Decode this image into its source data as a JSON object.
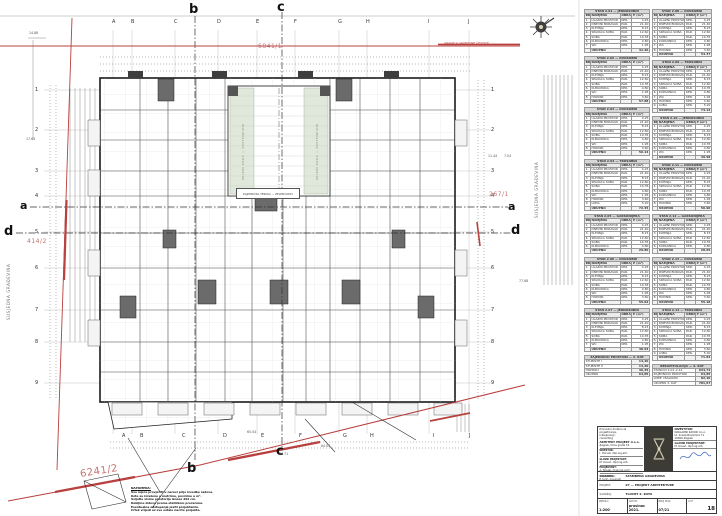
{
  "colors": {
    "boundary_red": "#b8403e",
    "parcel_red": "#c4706e",
    "green_roof": "#e0e8dc",
    "wall": "#1a1a1a"
  },
  "sheet": {
    "parcel_top": "6841/1",
    "parcel_right": "267/1",
    "parcel_left": "414/2",
    "parcel_bottom": "6241/2",
    "boundary_label": "GRANICA GRAĐEVNE ČESTICE",
    "section_a": "a",
    "section_b": "b",
    "section_c": "c",
    "section_d": "d",
    "grid_letters": [
      "A",
      "B",
      "C",
      "D",
      "E",
      "F",
      "G",
      "H",
      "I",
      "J"
    ],
    "grid_numbers": [
      "1",
      "2",
      "3",
      "4",
      "5",
      "6",
      "7",
      "8",
      "9"
    ],
    "dims": {
      "d1": "14.88",
      "d2": "17.63",
      "d3": "11.44",
      "d4": "7.04",
      "d5": "77.88",
      "d6": "65.04",
      "d7": "64.05",
      "d8": "84.71"
    },
    "neighbor_left": "SUSJEDNA GRAĐEVINA",
    "neighbor_right": "SUSJEDNA GRAĐEVINA",
    "green_left": "ZELENI KROV — EKSTENZIVNI",
    "green_right": "ZELENI KROV — EKSTENZIVNI",
    "courtyard_label": "ZAJEDNIČKA TERASA — ZELENI KROV"
  },
  "schedules": {
    "headers": [
      "BR.",
      "NAMJENA",
      "OBRADA",
      "P (m²)"
    ],
    "rooms": [
      [
        "1.",
        "ULAZNI PROSTOR",
        "KER.",
        "4.25"
      ],
      [
        "2.",
        "DNEVNI BORAVAK",
        "PAR.",
        "21.40"
      ],
      [
        "3.",
        "KUHINJA",
        "KER.",
        "8.15"
      ],
      [
        "4.",
        "SPAVAĆA SOBA",
        "PAR.",
        "12.60"
      ],
      [
        "5.",
        "SOBA",
        "PAR.",
        "10.35"
      ],
      [
        "6.",
        "KUPAONICA",
        "KER.",
        "4.80"
      ],
      [
        "7.",
        "WC",
        "KER.",
        "1.95"
      ],
      [
        "8.",
        "HODNIK",
        "KER.",
        "3.60"
      ],
      [
        "9.",
        "LOĐA",
        "KER.",
        "5.20"
      ],
      [
        "10.",
        "SPREMIŠTE",
        "KER.",
        "2.10"
      ]
    ],
    "sum_label": "UKUPNO",
    "left": [
      {
        "t": "STAN 2.01 — JEDNOSOBNI",
        "n": 7,
        "s": "41.26"
      },
      {
        "t": "STAN 2.02 — DVOSOBNI",
        "n": 8,
        "s": "57.88"
      },
      {
        "t": "STAN 2.03 — DVOSOBNI",
        "n": 8,
        "s": "56.14"
      },
      {
        "t": "STAN 2.04 — TROSOBNI",
        "n": 9,
        "s": "72.45"
      },
      {
        "t": "STAN 2.05 — GARSONIJERA",
        "n": 6,
        "s": "29.80"
      },
      {
        "t": "STAN 2.06 — DVOSOBNI",
        "n": 8,
        "s": "55.62"
      },
      {
        "t": "STAN 2.07 — JEDNOSOBNI",
        "n": 7,
        "s": "40.93"
      },
      {
        "t": "ZAJEDNIČKI PROSTORI — 2. KAT",
        "rows": [
          [
            "STUBIŠTE I",
            "14,20"
          ],
          [
            "STUBIŠTE II",
            "14,20"
          ],
          [
            "HODNICI",
            "36,45"
          ],
          [
            "UKUPNO",
            "64,85"
          ]
        ]
      }
    ],
    "right": [
      {
        "t": "STAN 2.08 — DVOSOBNI",
        "n": 8,
        "s": "54.37"
      },
      {
        "t": "STAN 2.09 — TROSOBNI",
        "n": 9,
        "s": "74.12"
      },
      {
        "t": "STAN 2.10 — JEDNOSOBNI",
        "n": 7,
        "s": "39.58"
      },
      {
        "t": "STAN 2.11 — DVOSOBNI",
        "n": 8,
        "s": "56.90"
      },
      {
        "t": "STAN 2.12 — GARSONIJERA",
        "n": 6,
        "s": "28.65"
      },
      {
        "t": "STAN 2.13 — DVOSOBNI",
        "n": 8,
        "s": "55.18"
      },
      {
        "t": "STAN 2.14 — TROSOBNI",
        "n": 9,
        "s": "71.84"
      },
      {
        "t": "REKAPITULACIJA — 2. KAT",
        "rows": [
          [
            "STANOVI 2.01–2.14",
            "634,72"
          ],
          [
            "ZAJEDNIČKI PROSTORI",
            "64,85"
          ],
          [
            "LOĐE I BALKONI",
            "82,10"
          ],
          [
            "UKUPNO 2. KAT",
            "781,67"
          ]
        ]
      }
    ]
  },
  "notes": {
    "title": "NAPOMENA:",
    "lines": [
      "Sve mjere provjeriti u naravi prije izvedbe radova.",
      "Kote su izražene u metrima, površine u m².",
      "Svijetle visine prostorija iznose 262 cm.",
      "Debljine zidova prema statičkom proračunu.",
      "Eventualna odstupanja javiti projektantu.",
      "Crtež vrijedi uz sve ostale nacrte projekta."
    ]
  },
  "titleblock": {
    "company_lines": [
      "Privredno društvo za",
      "projektiranje,",
      "inženjering i",
      "consulting"
    ],
    "company_name": "ARHITEKT PROJEKT d.o.o.",
    "company_addr": "Zagreb, Ulica grada 15",
    "left_rows": [
      [
        "DIREKTOR:",
        "I. Horvat, dipl.ing.arh."
      ],
      [
        "GLAVNI PROJEKTANT:",
        "M. Kovač, dipl.ing.arh."
      ],
      [
        "PROJEKTANT:",
        "A. Novak, mag.ing.arch."
      ],
      [
        "SURADNIK:",
        "P. Jurić, ing.građ."
      ]
    ],
    "investor_label": "INVESTITOR:",
    "investor_lines": [
      "NAKLADNI ZAVOD d.o.o.",
      "Ul. kneza Branimira 71",
      "10000 Zagreb"
    ],
    "designer_label": "GLAVNI PROJEKTANT:",
    "designer_name": "M. Kovač, dipl.ing.arh.",
    "building_label": "GRAĐEVINA:",
    "building_value": "STAMBENA GRAĐEVINA",
    "project_label": "PROJEKT:",
    "project_value": "07 — PROJEKT ARHITEKTURE",
    "content_label": "SADRŽAJ:",
    "content_value": "TLOCRT 2. KATA",
    "scale_label": "MJERILO",
    "scale_value": "1:200",
    "date_label": "DATUM",
    "date_value": "prosinac 2021.",
    "number_label": "BROJ PROJ.",
    "number_value": "07/21",
    "sheet_label": "LIST",
    "sheet_value": "18"
  }
}
